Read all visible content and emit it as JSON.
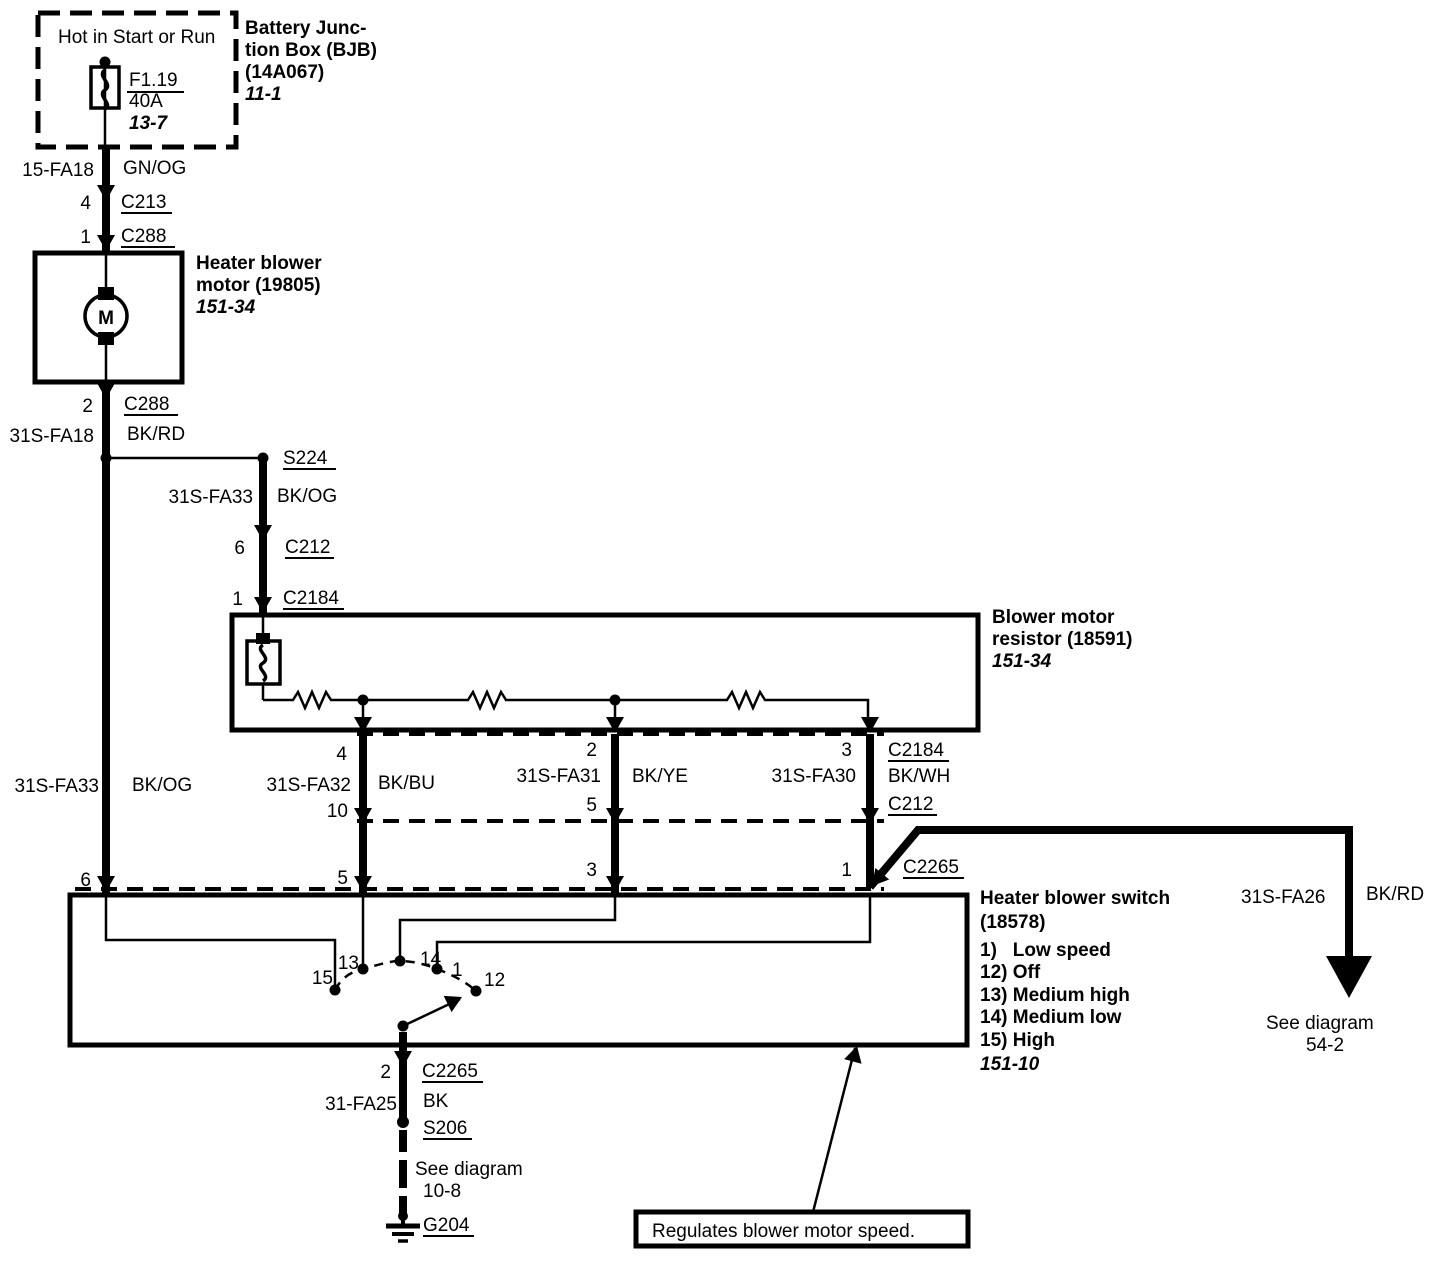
{
  "colors": {
    "ink": "#000000",
    "paper": "#ffffff"
  },
  "bjb": {
    "hot_label": "Hot in Start or Run",
    "fuse_id": "F1.19",
    "fuse_rating": "40A",
    "fuse_page": "13-7",
    "name_line1": "Battery Junc-",
    "name_line2": "tion Box (BJB)",
    "part": "(14A067)",
    "page": "11-1"
  },
  "motor": {
    "line1": "Heater blower",
    "line2": "motor (19805)",
    "page": "151-34",
    "symbol": "M"
  },
  "resistor": {
    "line1": "Blower motor",
    "line2": "resistor (18591)",
    "page": "151-34"
  },
  "switch": {
    "line1": "Heater blower switch",
    "line2": "(18578)",
    "items": [
      "1)   Low speed",
      "12) Off",
      "13) Medium high",
      "14) Medium low",
      "15) High"
    ],
    "page": "151-10",
    "contacts": {
      "c15": "15",
      "c13": "13",
      "c14": "14",
      "c1": "1",
      "c12": "12"
    }
  },
  "wires": {
    "w_fa18": {
      "id": "15-FA18",
      "color": "GN/OG"
    },
    "w_31s_fa18": {
      "id": "31S-FA18",
      "color": "BK/RD"
    },
    "w_31s_fa33_branch": {
      "id": "31S-FA33",
      "color": "BK/OG"
    },
    "w_31s_fa33": {
      "id": "31S-FA33",
      "color": "BK/OG"
    },
    "w_31s_fa32": {
      "id": "31S-FA32",
      "color": "BK/BU"
    },
    "w_31s_fa31": {
      "id": "31S-FA31",
      "color": "BK/YE"
    },
    "w_31s_fa30": {
      "id": "31S-FA30",
      "color": "BK/WH"
    },
    "w_31s_fa26": {
      "id": "31S-FA26",
      "color": "BK/RD"
    },
    "w_31_fa25": {
      "id": "31-FA25",
      "color": "BK"
    }
  },
  "connectors": {
    "c213": "C213",
    "c288": "C288",
    "s224": "S224",
    "c212": "C212",
    "c2184": "C2184",
    "c2265": "C2265",
    "s206": "S206",
    "g204": "G204"
  },
  "pins": {
    "top_c213": "4",
    "top_c288": "1",
    "motor_c288": "2",
    "branch_c212": "6",
    "branch_c2184": "1",
    "b_c2184": "4",
    "b_c212": "10",
    "b_c2265": "5",
    "c_c2184": "2",
    "c_c212": "5",
    "c_c2265": "3",
    "d_c2184": "3",
    "d_c212": "1",
    "d_c2265": "1",
    "a_c2265": "6",
    "sw_c2265": "2"
  },
  "refs": {
    "a_letter": "A",
    "see_a_line1": "See diagram",
    "see_a_line2": "54-2",
    "see_g_line1": "See diagram",
    "see_g_line2": "10-8"
  },
  "note": {
    "text": "Regulates blower motor speed."
  }
}
